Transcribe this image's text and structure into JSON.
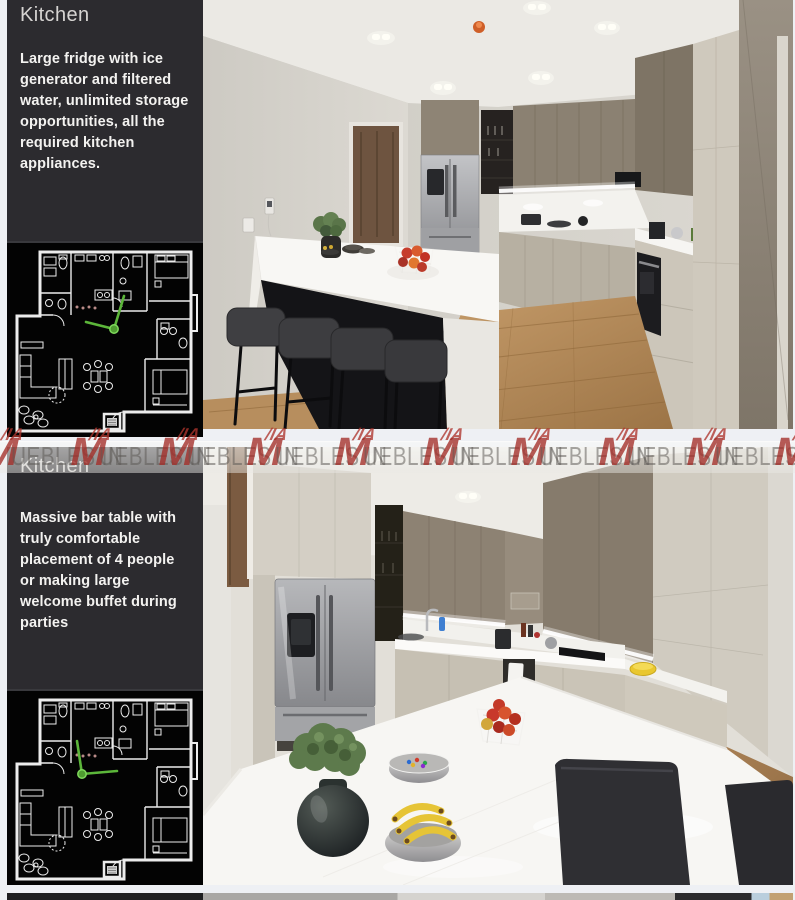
{
  "watermark": {
    "accent_top": "/IA",
    "accent_letter": "M",
    "text": "UEBLES IN",
    "red": "#a5302a",
    "gray": "#5f5c58"
  },
  "sections": [
    {
      "title": "Kitchen",
      "description": "Large fridge with ice generator and filtered water, unlimited storage opportunities, all the required kitchen appliances."
    },
    {
      "title": "Kitchen",
      "description": "Massive bar table with truly comfortable placement of 4 people or making large welcome buffet during parties"
    }
  ],
  "colors": {
    "sidebar_bg": "#2c2b2f",
    "floorplan_bg": "#030303",
    "camera_marker_green": "#5cb63a",
    "watermark_red": "#a5302a"
  }
}
